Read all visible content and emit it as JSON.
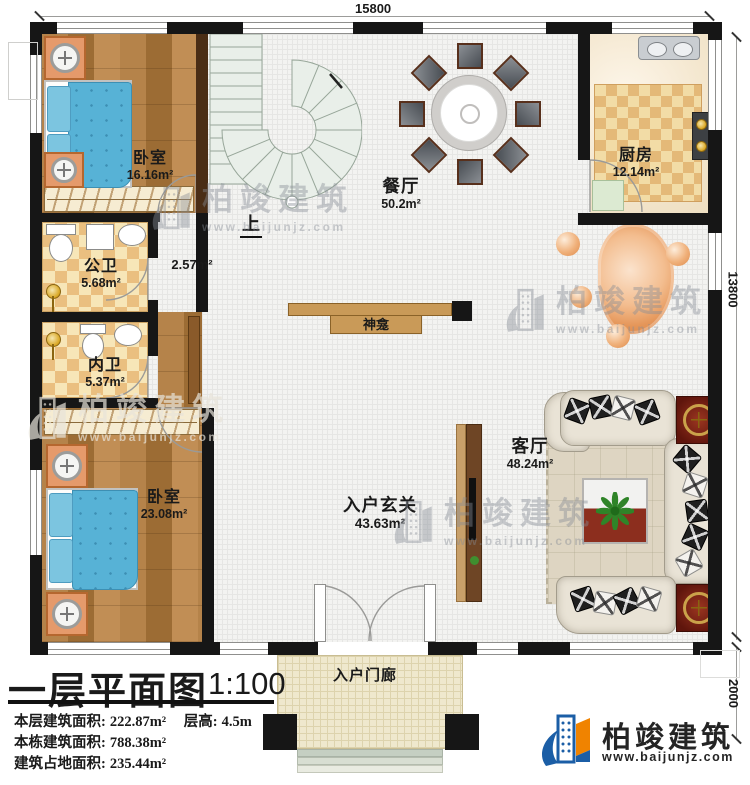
{
  "watermark": {
    "brand": "柏竣建筑",
    "url": "www.baijunjz.com"
  },
  "footer": {
    "brand": "柏竣建筑",
    "url": "www.baijunjz.com"
  },
  "dimensions": {
    "top": "15800",
    "right": "13800",
    "bottom_right": "2000"
  },
  "rooms": {
    "bedroom_top": {
      "name": "卧室",
      "area": "16.16m²"
    },
    "bedroom_bottom": {
      "name": "卧室",
      "area": "23.08m²"
    },
    "public_bath": {
      "name": "公卫",
      "area": "5.68m²"
    },
    "inner_bath": {
      "name": "内卫",
      "area": "5.37m²"
    },
    "dining": {
      "name": "餐厅",
      "area": "50.2m²"
    },
    "kitchen": {
      "name": "厨房",
      "area": "12.14m²"
    },
    "living": {
      "name": "客厅",
      "area": "48.24m²"
    },
    "foyer": {
      "name": "入户玄关",
      "area": "43.63m²"
    },
    "porch": {
      "name": "入户门廊"
    },
    "shrine": {
      "name": "神龛"
    },
    "stair_hall": {
      "area": "2.57m²"
    },
    "stairs": {
      "up_label": "上"
    }
  },
  "title_block": {
    "title": "一层平面图",
    "scale": "1:100",
    "stats": [
      {
        "label": "本层建筑面积:",
        "value": "222.87m²"
      },
      {
        "label": "层高:",
        "value": "4.5m"
      },
      {
        "label": "本栋建筑面积:",
        "value": "788.38m²"
      },
      {
        "label": "建筑占地面积:",
        "value": "235.44m²"
      }
    ]
  }
}
